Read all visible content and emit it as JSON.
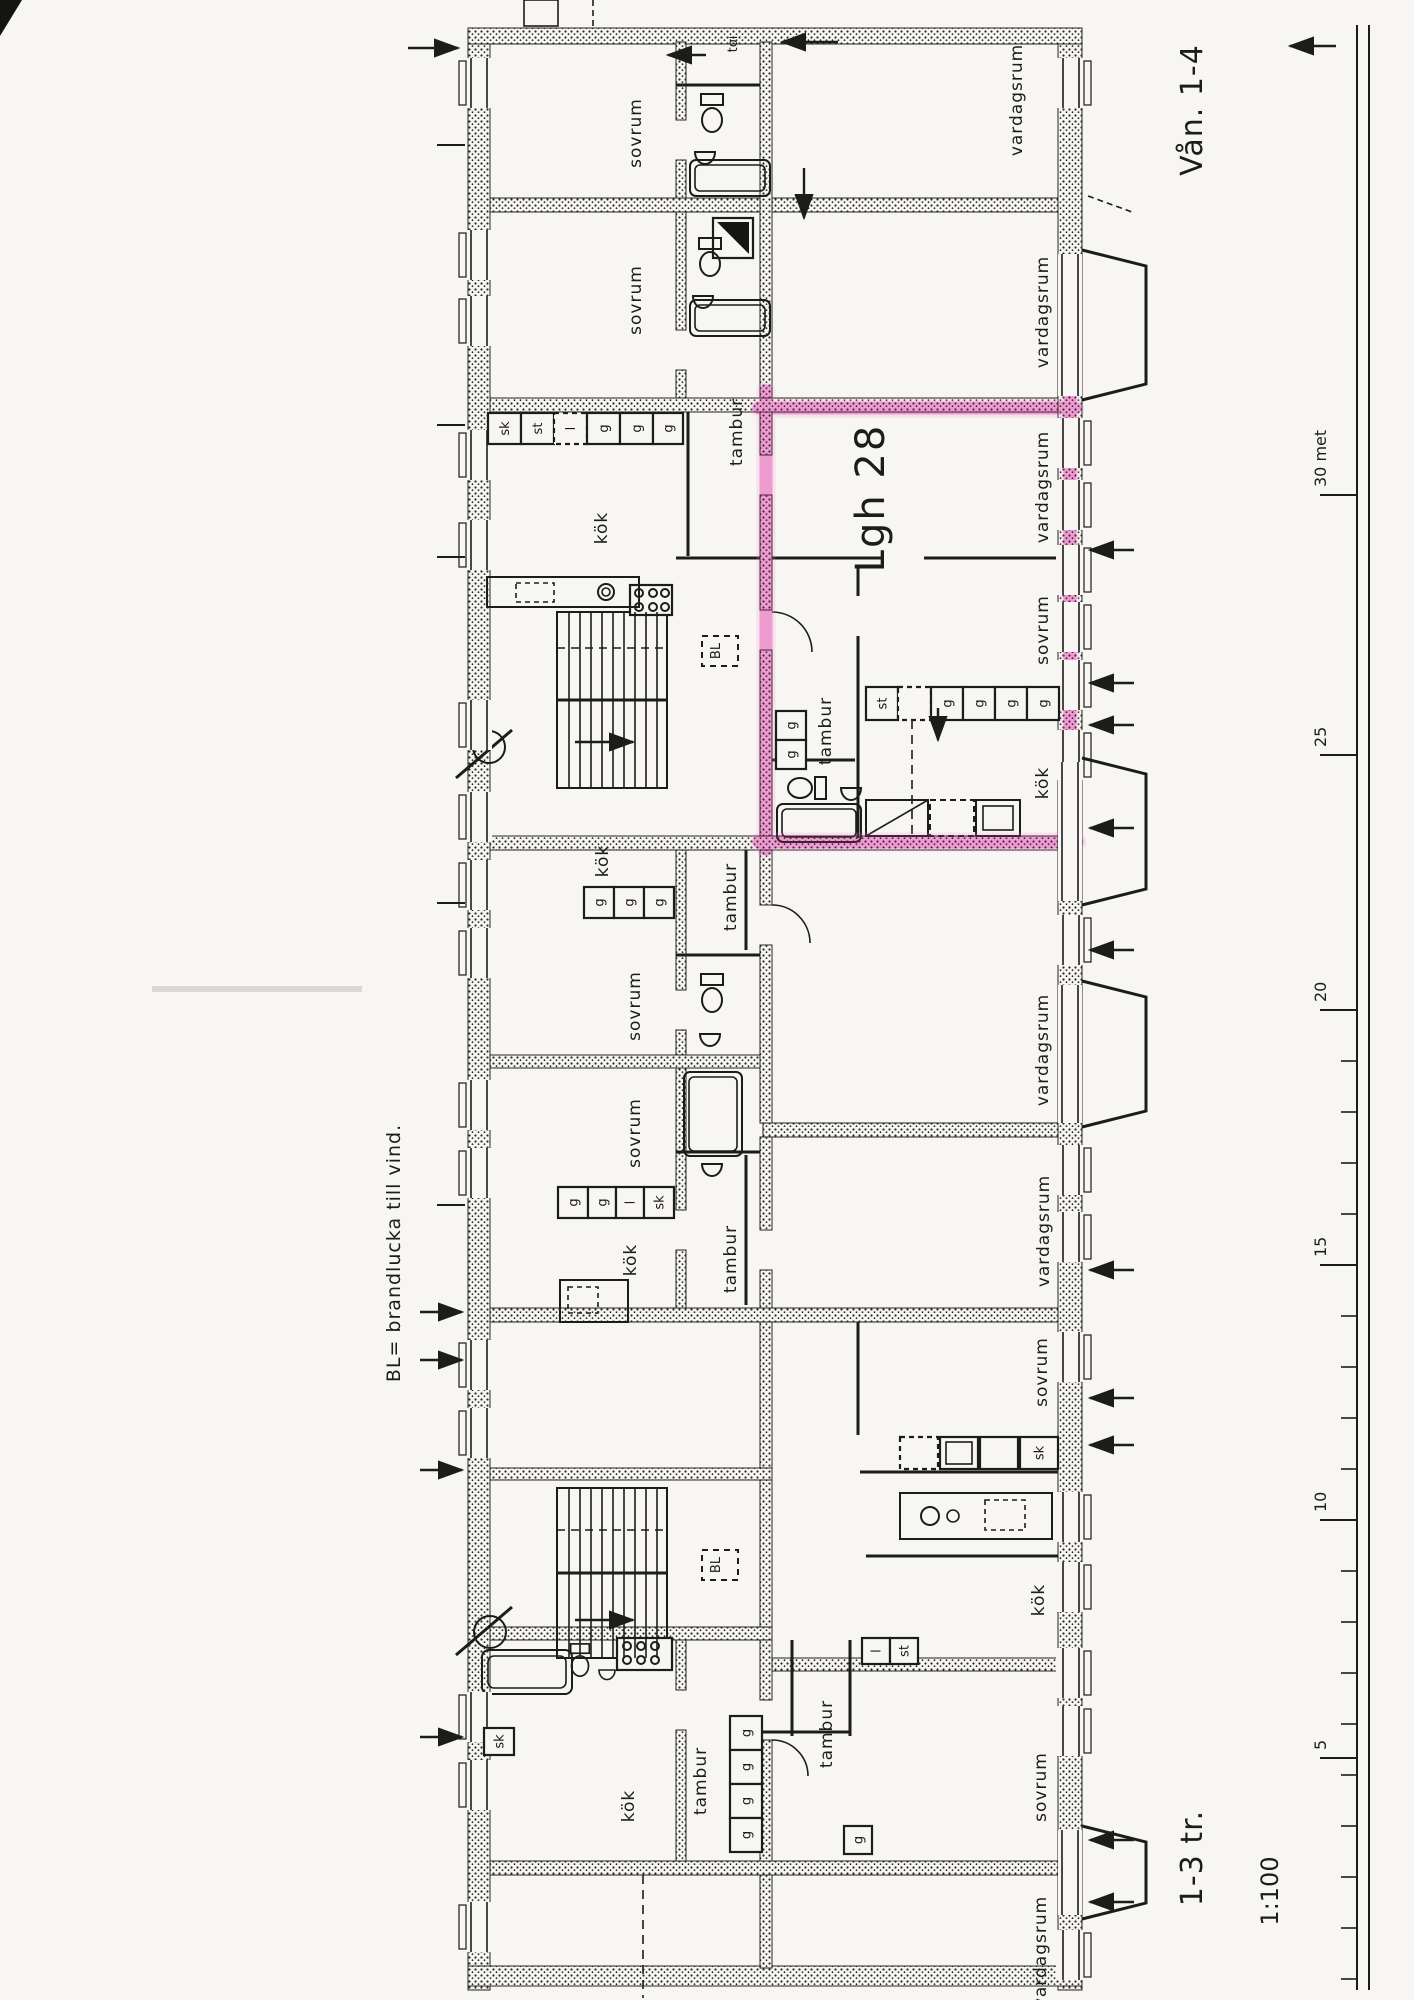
{
  "page": {
    "background": "#f7f6f2",
    "ink": "#1c1c1a"
  },
  "titles": {
    "floors": "Vån. 1-4",
    "stairs": "1-3 tr.",
    "scale": "1:100",
    "legend": "BL= brandlucka till vind.",
    "toilet": "toi"
  },
  "highlight": {
    "apartment": "Lgh 28",
    "color": "#ee5fc4"
  },
  "words": {
    "bedroom": "sovrum",
    "living": "vardagsrum",
    "hall": "tambur",
    "kitchen": "kök"
  },
  "abbr": {
    "wardrobe": "g",
    "cupboard": "sk",
    "cleaning": "st",
    "linen": "l",
    "fire_hatch": "BL"
  },
  "ruler": {
    "labels": {
      "m30": "30 met",
      "m25": "25",
      "m20": "20",
      "m15": "15",
      "m10": "10",
      "m5": "5"
    }
  }
}
